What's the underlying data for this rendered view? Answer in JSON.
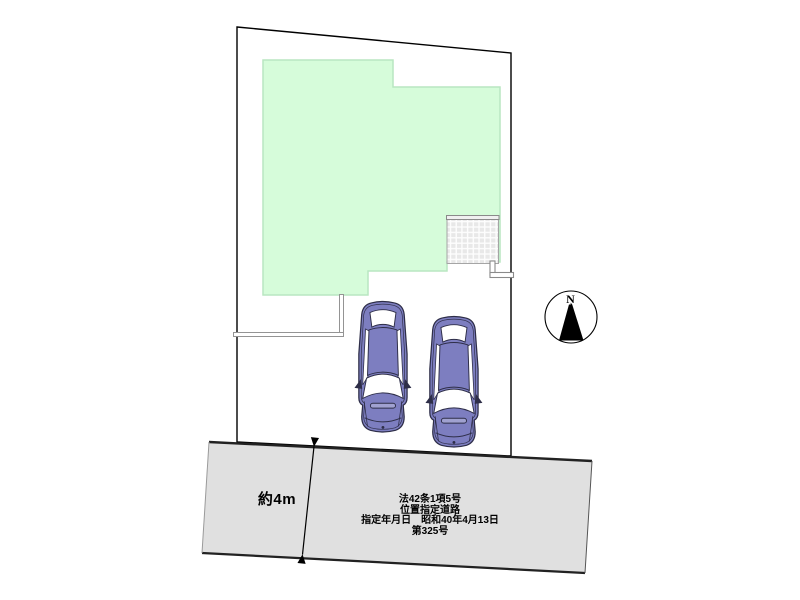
{
  "plan": {
    "type": "site-plan",
    "north_label": "N",
    "road_width_label": "約4m",
    "road_designation_lines": [
      "法42条1項5号",
      "位置指定道路",
      "指定年月日　昭和40年4月13日",
      "第325号"
    ],
    "parked_cars": 2
  },
  "colors": {
    "building_fill": "#d6fcda",
    "building_border": "#b9e6c1",
    "road_fill": "#e0e0e0",
    "road_edge": "#222222",
    "car_body": "#7d7ec0",
    "car_outline": "#2e2e48",
    "boundary": "#000000",
    "fence": "#949494",
    "tile_fill": "#e8e8e8"
  }
}
